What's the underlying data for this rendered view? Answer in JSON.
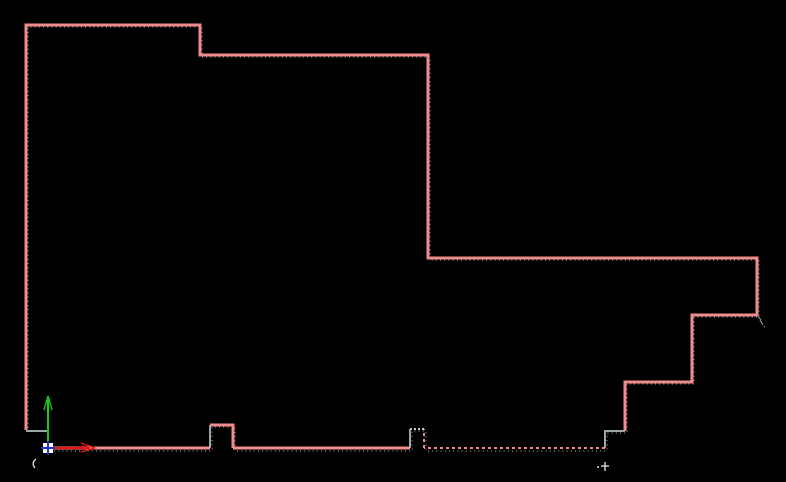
{
  "app": {
    "description": "CAD model-space viewport showing a closed polyline profile, UCS icon and blip marks",
    "background_color": "#000000"
  },
  "colors": {
    "outline_pink": "#f28b8b",
    "outline_gray": "#9da6a8",
    "notch_top_gray": "#c6cdc6",
    "trace_gray": "#8f8f8f",
    "axis_red": "#ee1511",
    "axis_green": "#17cc17",
    "origin_blue": "#2334cc",
    "origin_white": "#ffffff",
    "blip_white": "#dcdcdc",
    "cursor_gray": "#8a9096"
  },
  "drawing": {
    "outline_segments": [
      {
        "name": "profile-main-outline",
        "color": "outline_pink",
        "dash": "none",
        "width": 3,
        "points": [
          [
            26,
            430
          ],
          [
            26,
            25
          ],
          [
            200,
            25
          ],
          [
            200,
            55
          ],
          [
            428,
            55
          ],
          [
            428,
            258
          ],
          [
            757,
            258
          ],
          [
            757,
            315
          ],
          [
            692,
            315
          ],
          [
            692,
            382
          ],
          [
            625,
            382
          ],
          [
            625,
            431
          ]
        ]
      },
      {
        "name": "profile-step-bottom-right",
        "color": "outline_gray",
        "dash": "none",
        "width": 2,
        "points": [
          [
            625,
            431
          ],
          [
            605,
            431
          ],
          [
            605,
            448
          ]
        ]
      },
      {
        "name": "profile-bottom-dashed",
        "color": "outline_pink",
        "dash": "3,3",
        "width": 2,
        "points": [
          [
            605,
            448
          ],
          [
            424,
            448
          ]
        ]
      },
      {
        "name": "profile-notch2-right",
        "color": "outline_pink",
        "dash": "3,3",
        "width": 2,
        "points": [
          [
            424,
            448
          ],
          [
            424,
            429
          ]
        ]
      },
      {
        "name": "profile-notch2-top",
        "color": "notch_top_gray",
        "dash": "2,2",
        "width": 2,
        "points": [
          [
            424,
            429
          ],
          [
            410,
            429
          ]
        ]
      },
      {
        "name": "profile-notch2-left",
        "color": "outline_gray",
        "dash": "none",
        "width": 2,
        "points": [
          [
            410,
            429
          ],
          [
            410,
            448
          ]
        ]
      },
      {
        "name": "profile-bottom-mid",
        "color": "outline_pink",
        "dash": "none",
        "width": 3,
        "points": [
          [
            410,
            448
          ],
          [
            233,
            448
          ]
        ]
      },
      {
        "name": "profile-notch1",
        "color": "outline_pink",
        "dash": "none",
        "width": 3,
        "points": [
          [
            233,
            448
          ],
          [
            233,
            425
          ],
          [
            210,
            425
          ]
        ]
      },
      {
        "name": "profile-notch1-left",
        "color": "outline_gray",
        "dash": "none",
        "width": 2,
        "points": [
          [
            210,
            425
          ],
          [
            210,
            448
          ]
        ]
      },
      {
        "name": "profile-bottom-left",
        "color": "outline_pink",
        "dash": "none",
        "width": 3,
        "points": [
          [
            210,
            448
          ],
          [
            48,
            448
          ]
        ]
      },
      {
        "name": "profile-step-origin",
        "color": "outline_gray",
        "dash": "none",
        "width": 2,
        "points": [
          [
            48,
            448
          ],
          [
            48,
            431
          ],
          [
            26,
            431
          ]
        ]
      }
    ],
    "trace_outline": {
      "name": "profile-dotted-trace",
      "color": "trace_gray",
      "dash": "1,3.2",
      "width": 1.2,
      "points": [
        [
          28,
          432
        ],
        [
          28,
          27
        ],
        [
          202,
          27
        ],
        [
          202,
          57
        ],
        [
          430,
          57
        ],
        [
          430,
          260
        ],
        [
          759,
          260
        ],
        [
          759,
          317
        ],
        [
          694,
          317
        ],
        [
          694,
          384
        ],
        [
          627,
          384
        ],
        [
          627,
          433
        ],
        [
          607,
          433
        ],
        [
          607,
          451
        ],
        [
          426,
          451
        ],
        [
          426,
          431
        ],
        [
          412,
          431
        ],
        [
          412,
          451
        ],
        [
          235,
          451
        ],
        [
          235,
          427
        ],
        [
          212,
          427
        ],
        [
          212,
          451
        ],
        [
          50,
          451
        ]
      ]
    }
  },
  "ucs_icon": {
    "origin": [
      48,
      448
    ],
    "origin_box": {
      "x": 43,
      "y": 443,
      "w": 10,
      "h": 10
    },
    "y_axis": {
      "line": [
        [
          48,
          448
        ],
        [
          48,
          401
        ]
      ],
      "arrow": [
        [
          [
            48,
            396
          ],
          [
            44,
            410
          ]
        ],
        [
          [
            48,
            396
          ],
          [
            52,
            410
          ]
        ],
        [
          [
            46,
            402
          ],
          [
            50,
            399
          ]
        ]
      ]
    },
    "x_axis": {
      "line": [
        [
          54,
          448
        ],
        [
          90,
          448
        ]
      ],
      "arrow": [
        [
          [
            95,
            448
          ],
          [
            81,
            443
          ]
        ],
        [
          [
            95,
            448
          ],
          [
            81,
            452
          ]
        ],
        [
          [
            84,
            446
          ],
          [
            74,
            449
          ]
        ]
      ]
    },
    "cross": {
      "v": [
        [
          48,
          441
        ],
        [
          48,
          455
        ]
      ],
      "h": [
        [
          41,
          448
        ],
        [
          55,
          448
        ]
      ]
    }
  },
  "blips": [
    {
      "name": "blip-arc-left",
      "type": "path",
      "d": "M 36 459 Q 31 463 35 468",
      "width": 1.4
    },
    {
      "name": "blip-plus-right-v",
      "type": "line",
      "points": [
        [
          605,
          462
        ],
        [
          605,
          471
        ]
      ],
      "width": 1.4
    },
    {
      "name": "blip-plus-right-h",
      "type": "line",
      "points": [
        [
          601,
          466
        ],
        [
          609,
          466
        ]
      ],
      "width": 1.4
    },
    {
      "name": "blip-dot-right",
      "type": "dot",
      "cx": 598,
      "cy": 467,
      "r": 1
    }
  ],
  "cursor_mark": {
    "name": "pick-cursor-mark",
    "strokes": [
      [
        [
          757,
          315
        ],
        [
          761,
          320
        ]
      ],
      [
        [
          760,
          320
        ],
        [
          763,
          325
        ]
      ],
      [
        [
          764,
          326
        ],
        [
          765,
          327
        ]
      ]
    ]
  }
}
